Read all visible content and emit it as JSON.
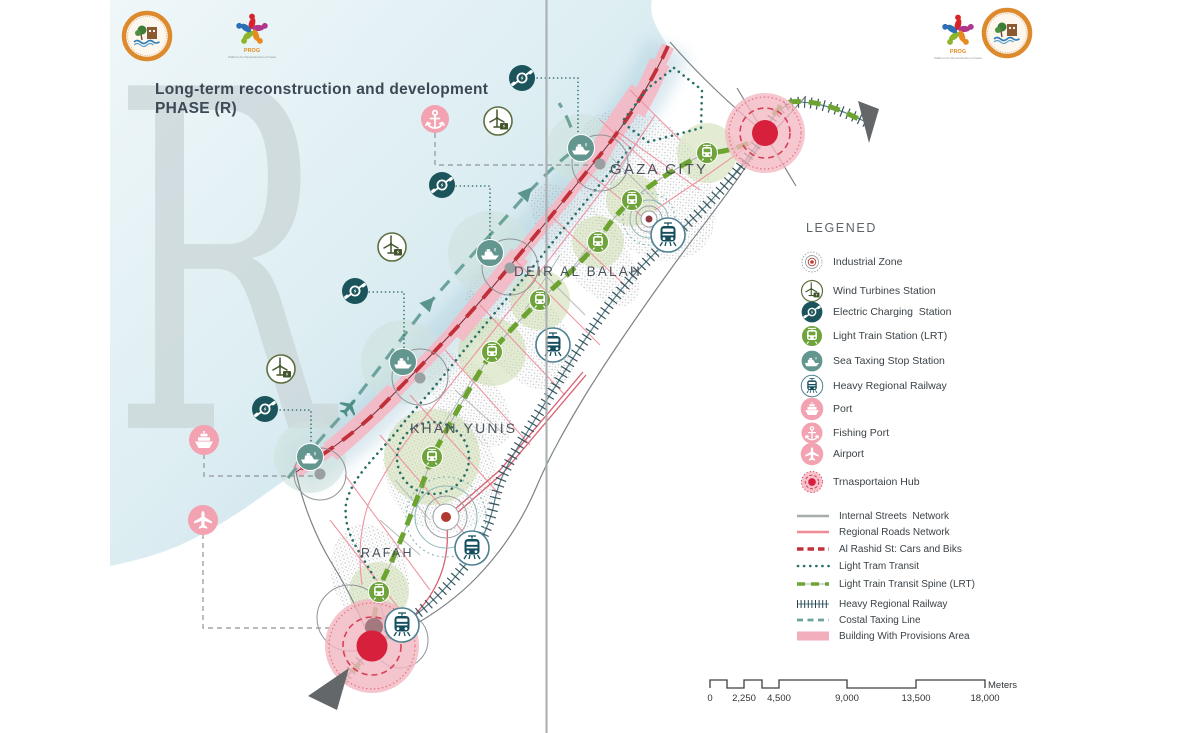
{
  "title": {
    "line1": "Long-term reconstruction and development",
    "line2": "PHASE (R)",
    "watermark": "R"
  },
  "logos": {
    "prog_label": "PROG",
    "prog_tagline": "Platform for Reconstruction of Gaza"
  },
  "map": {
    "labels": {
      "gaza_city": "GAZA CITY",
      "deir_al_balah": "DEIR AL BALAH",
      "khan_yunis": "KHAN YUNIS",
      "rafah": "RAFAH"
    }
  },
  "legend": {
    "title": "LEGENED",
    "point_items": [
      {
        "icon": "industrial-zone-icon",
        "label": "Industrial Zone"
      },
      {
        "icon": "wind-turbine-icon",
        "label": "Wind Turbines Station"
      },
      {
        "icon": "electric-charging-icon",
        "label": "Electric Charging  Station"
      },
      {
        "icon": "light-train-station-icon",
        "label": "Light Train Station (LRT)"
      },
      {
        "icon": "sea-taxi-stop-icon",
        "label": "Sea Taxing Stop Station"
      },
      {
        "icon": "heavy-railway-station-icon",
        "label": "Heavy Regional Railway"
      },
      {
        "icon": "port-icon",
        "label": "Port"
      },
      {
        "icon": "fishing-port-icon",
        "label": "Fishing Port"
      },
      {
        "icon": "airport-icon",
        "label": "Airport"
      },
      {
        "icon": "transportation-hub-icon",
        "label": "Trnasportaion Hub"
      }
    ],
    "line_items": [
      {
        "swatch": "internal-streets-line",
        "label": "Internal Streets  Network"
      },
      {
        "swatch": "regional-roads-line",
        "label": "Regional Roads Network"
      },
      {
        "swatch": "al-rashid-line",
        "label": "Al Rashid St: Cars and Biks"
      },
      {
        "swatch": "light-tram-line",
        "label": "Light Tram Transit"
      },
      {
        "swatch": "lrt-spine-line",
        "label": "Light Train Transit Spine (LRT)"
      },
      {
        "swatch": "heavy-railway-line",
        "label": "Heavy Regional Railway"
      },
      {
        "swatch": "coastal-taxi-line",
        "label": "Costal Taxing Line"
      },
      {
        "swatch": "provisions-area-swatch",
        "label": "Building With Provisions Area"
      }
    ]
  },
  "scale_bar": {
    "ticks": [
      "0",
      "2,250",
      "4,500",
      "9,000",
      "13,500",
      "18,000"
    ],
    "unit": "Meters"
  },
  "colors": {
    "lrt_green": "#6da32f",
    "station_green": "#6fa33c",
    "tram_teal": "#2a6f66",
    "coastal_teal": "#6ca39c",
    "alrashid_red": "#c13038",
    "regional_pink": "#f08a97",
    "internal_gray": "#a8abad",
    "railway_dark": "#27454e",
    "hub_red": "#d6203c",
    "provisions_pink": "#f3aebd",
    "pink_icon": "#f2a2b1",
    "charge_teal": "#1b545b",
    "seataxi_teal": "#649690",
    "sea_blue": "#bedde8"
  }
}
